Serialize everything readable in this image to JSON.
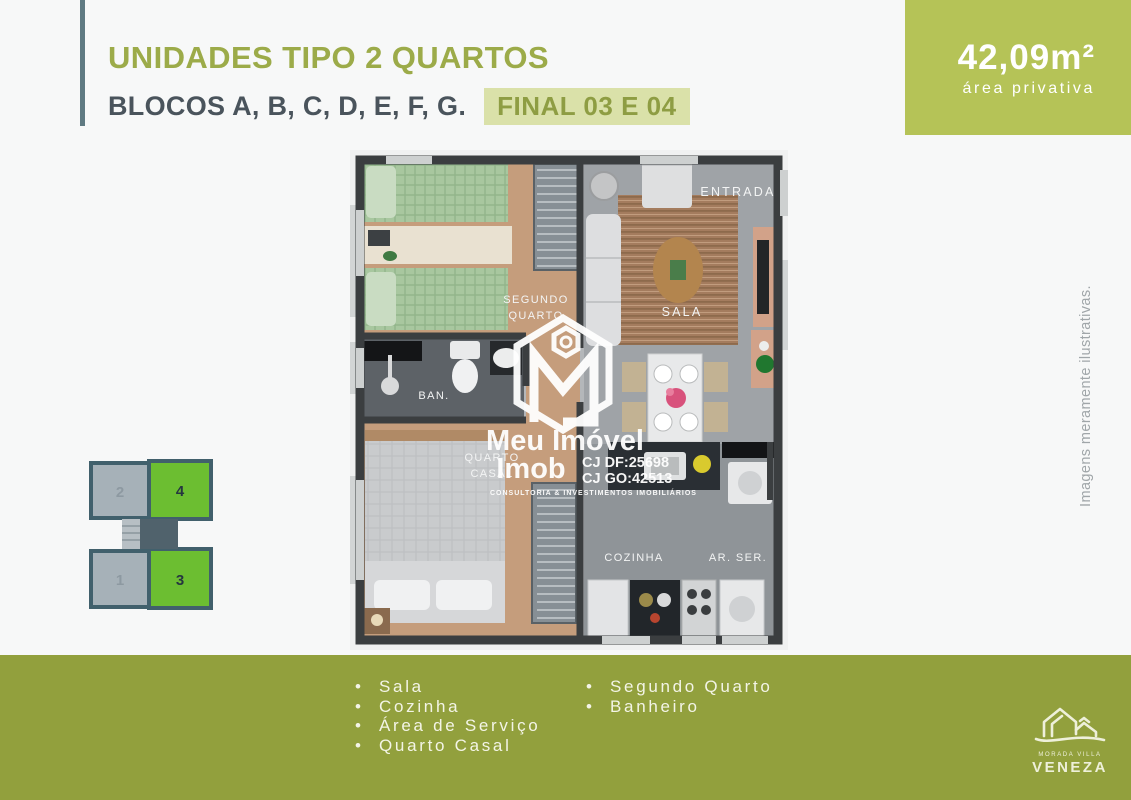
{
  "colors": {
    "accent_green_box": "#b5c357",
    "footer_green": "#92a03d",
    "title_olive": "#9cab49",
    "heading_dark": "#4a545c",
    "badge_bg": "#dae1a9",
    "badge_text": "#8e9d43",
    "unit_highlight_green": "#6cbe31",
    "unit_gray": "#a6b1b8",
    "diagram_border": "#41606c",
    "accent_bar": "#5f7a82"
  },
  "header": {
    "title": "UNIDADES TIPO 2 QUARTOS",
    "subtitle": "BLOCOS A, B, C, D, E, F, G.",
    "badge": "FINAL 03 E 04"
  },
  "area_box": {
    "value": "42,09m²",
    "label": "área privativa"
  },
  "floorplan": {
    "labels": {
      "entrada": "ENTRADA",
      "segundo_quarto_line1": "SEGUNDO",
      "segundo_quarto_line2": "QUARTO",
      "sala": "SALA",
      "banheiro": "BAN.",
      "quarto_casal_line1": "QUARTO",
      "quarto_casal_line2": "CASAL",
      "cozinha": "COZINHA",
      "area_servico": "AR. SER."
    }
  },
  "watermark": {
    "brand_line1": "Meu Imóvel",
    "brand_line2": "Imob",
    "registration_df": "CJ DF:25698",
    "registration_go": "CJ GO:42513",
    "tagline": "CONSULTORIA & INVESTIMENTOS IMOBILIÁRIOS"
  },
  "block_diagram": {
    "units": [
      {
        "number": "2",
        "highlighted": false
      },
      {
        "number": "4",
        "highlighted": true
      },
      {
        "number": "1",
        "highlighted": false
      },
      {
        "number": "3",
        "highlighted": true
      }
    ]
  },
  "side_note": "Imagens meramente ilustrativas.",
  "features": {
    "left": [
      "Sala",
      "Cozinha",
      "Área de Serviço",
      "Quarto Casal"
    ],
    "right": [
      "Segundo Quarto",
      "Banheiro"
    ]
  },
  "developer_logo": {
    "tagline": "MORADA VILLA",
    "name": "VENEZA"
  }
}
